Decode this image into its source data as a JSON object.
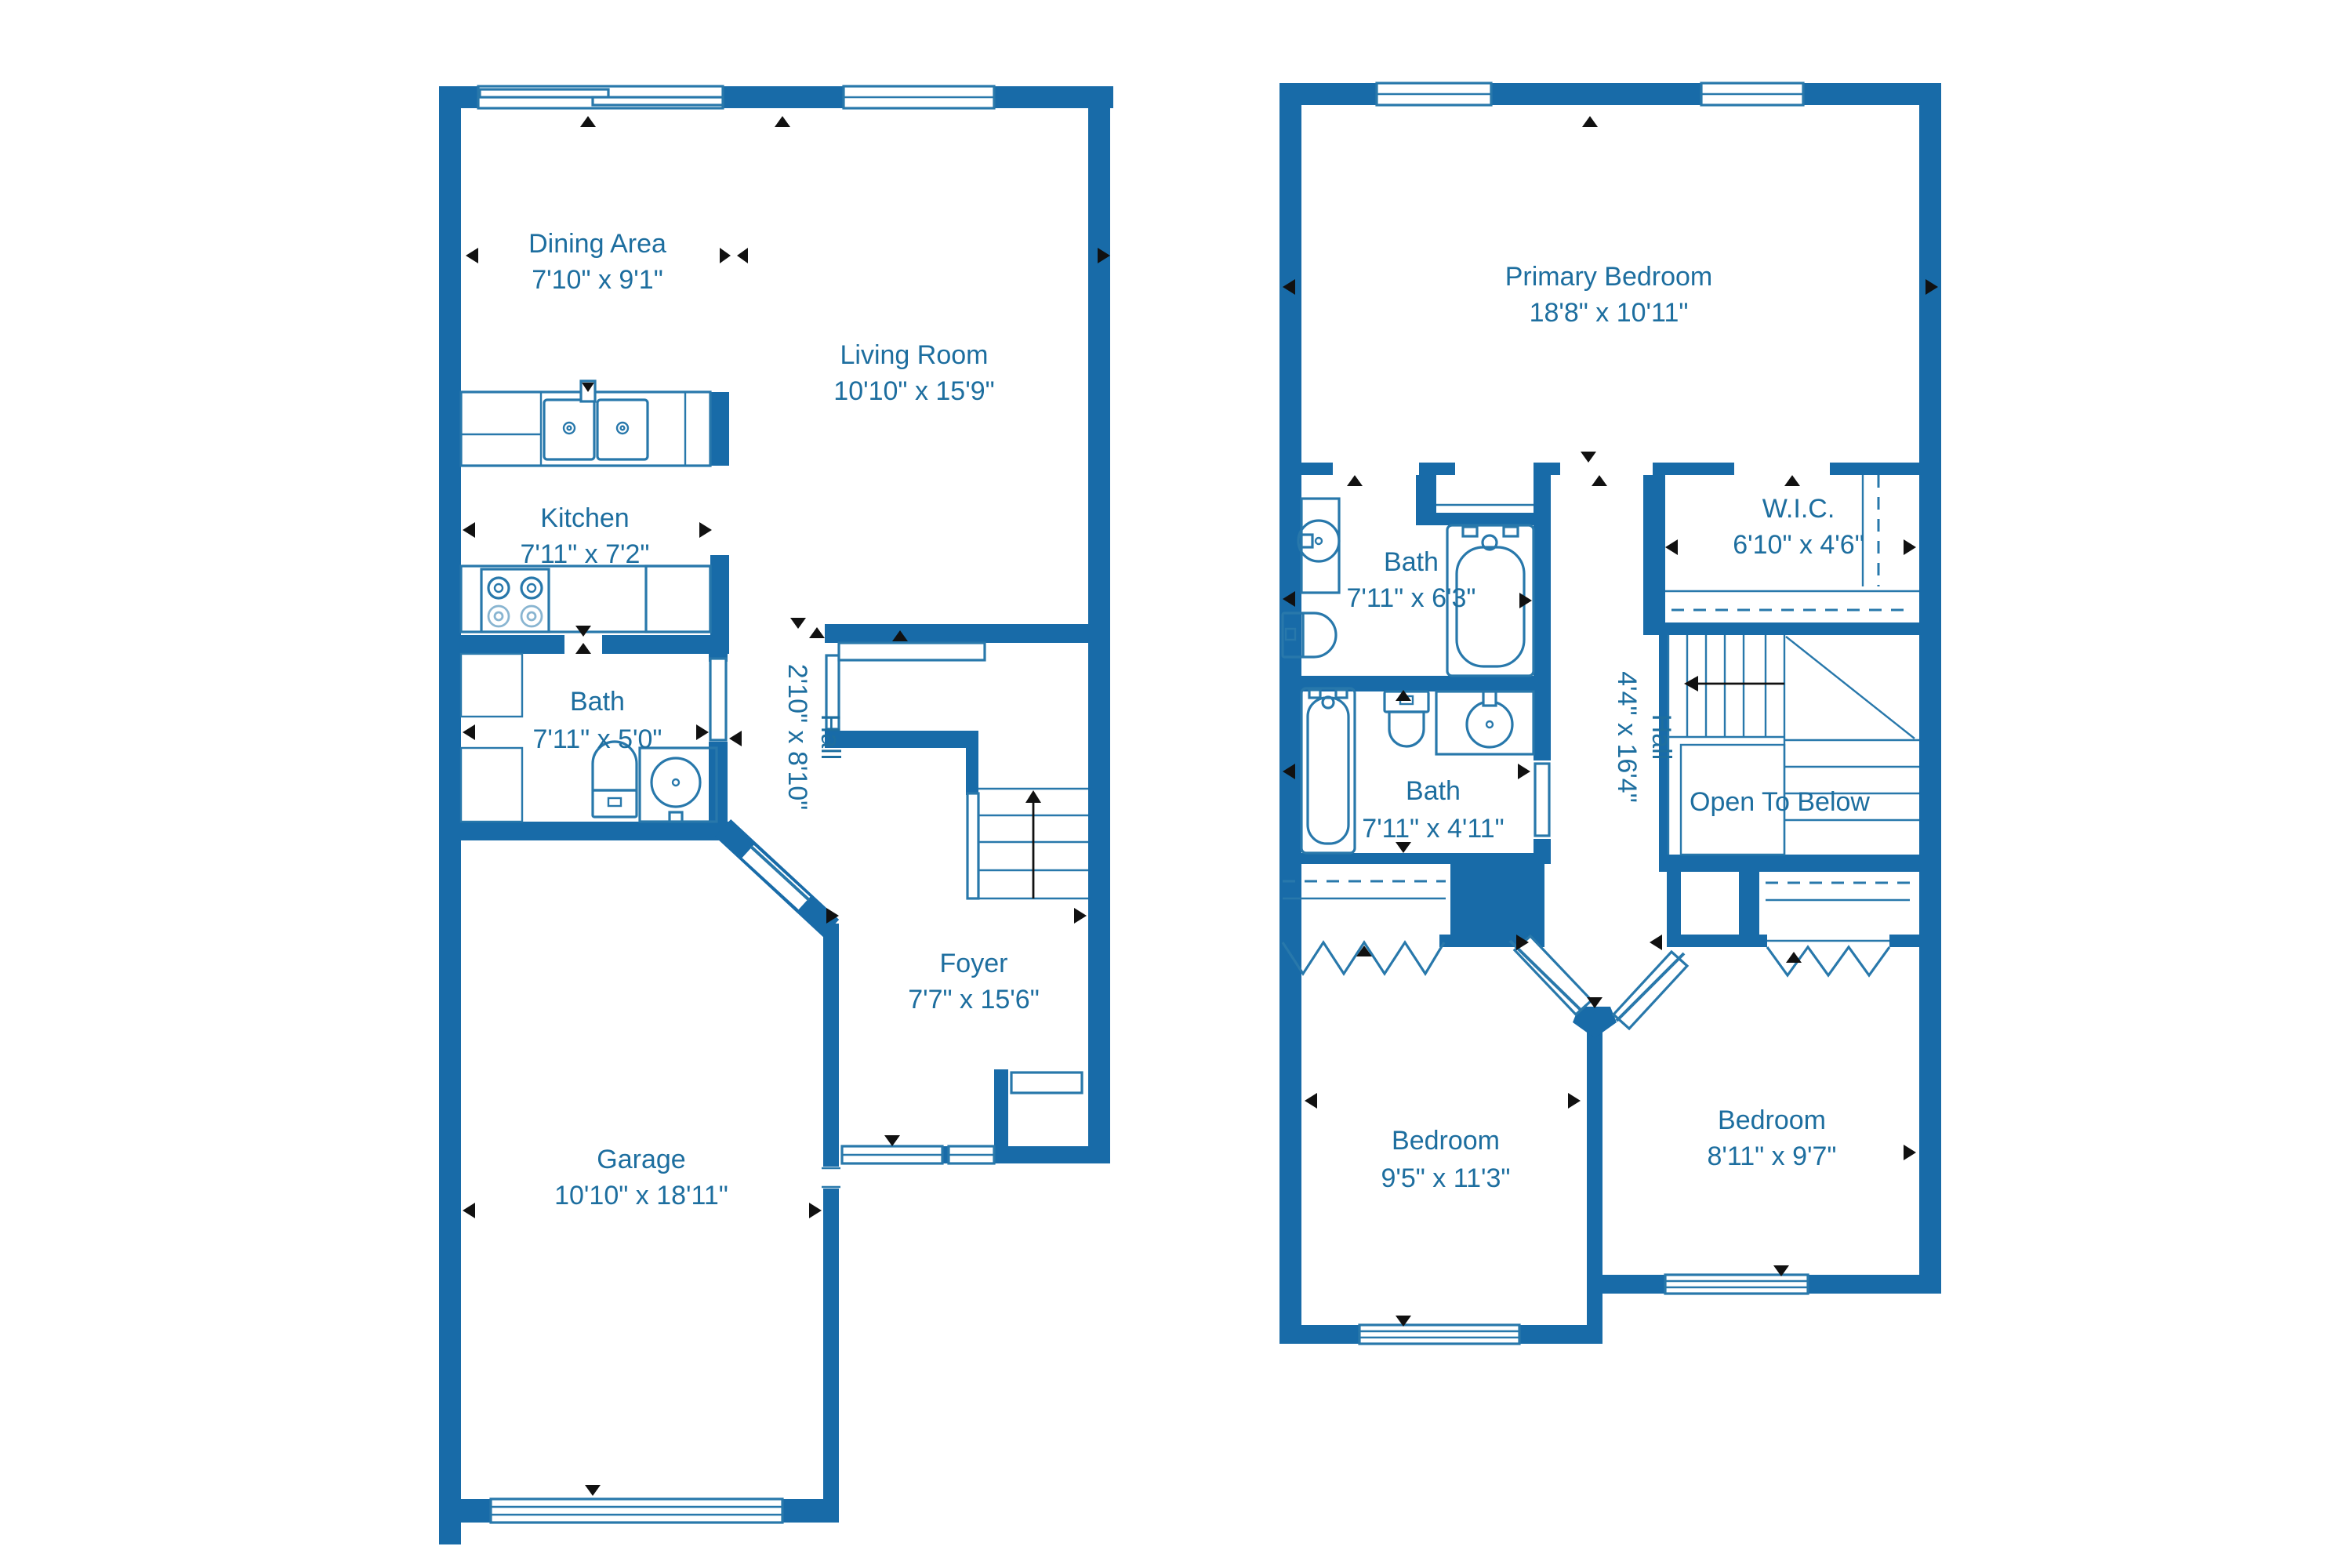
{
  "title": "Two-floor residential floor plan",
  "colors": {
    "wall": "#186ba8",
    "label": "#1d6e9f",
    "fixture": "#2878ab",
    "marker": "#111111",
    "bg": "#ffffff"
  },
  "floor1": {
    "dining": {
      "name": "Dining Area",
      "dims": "7'10\" x 9'1\""
    },
    "living": {
      "name": "Living Room",
      "dims": "10'10\" x 15'9\""
    },
    "kitchen": {
      "name": "Kitchen",
      "dims": "7'11\" x 7'2\""
    },
    "bath": {
      "name": "Bath",
      "dims": "7'11\" x 5'0\""
    },
    "hall": {
      "name": "Hall",
      "dims": "2'10\" x 8'10\""
    },
    "foyer": {
      "name": "Foyer",
      "dims": "7'7\" x 15'6\""
    },
    "garage": {
      "name": "Garage",
      "dims": "10'10\" x 18'11\""
    }
  },
  "floor2": {
    "primary": {
      "name": "Primary Bedroom",
      "dims": "18'8\" x 10'11\""
    },
    "bath_top": {
      "name": "Bath",
      "dims": "7'11\" x 6'3\""
    },
    "wic": {
      "name": "W.I.C.",
      "dims": "6'10\" x 4'6\""
    },
    "bath_bottom": {
      "name": "Bath",
      "dims": "7'11\" x 4'11\""
    },
    "hall": {
      "name": "Hall",
      "dims": "4'4\" x 16'4\""
    },
    "open_to_below": {
      "name": "Open To Below"
    },
    "bedroom_left": {
      "name": "Bedroom",
      "dims": "9'5\" x 11'3\""
    },
    "bedroom_right": {
      "name": "Bedroom",
      "dims": "8'11\" x 9'7\""
    }
  }
}
